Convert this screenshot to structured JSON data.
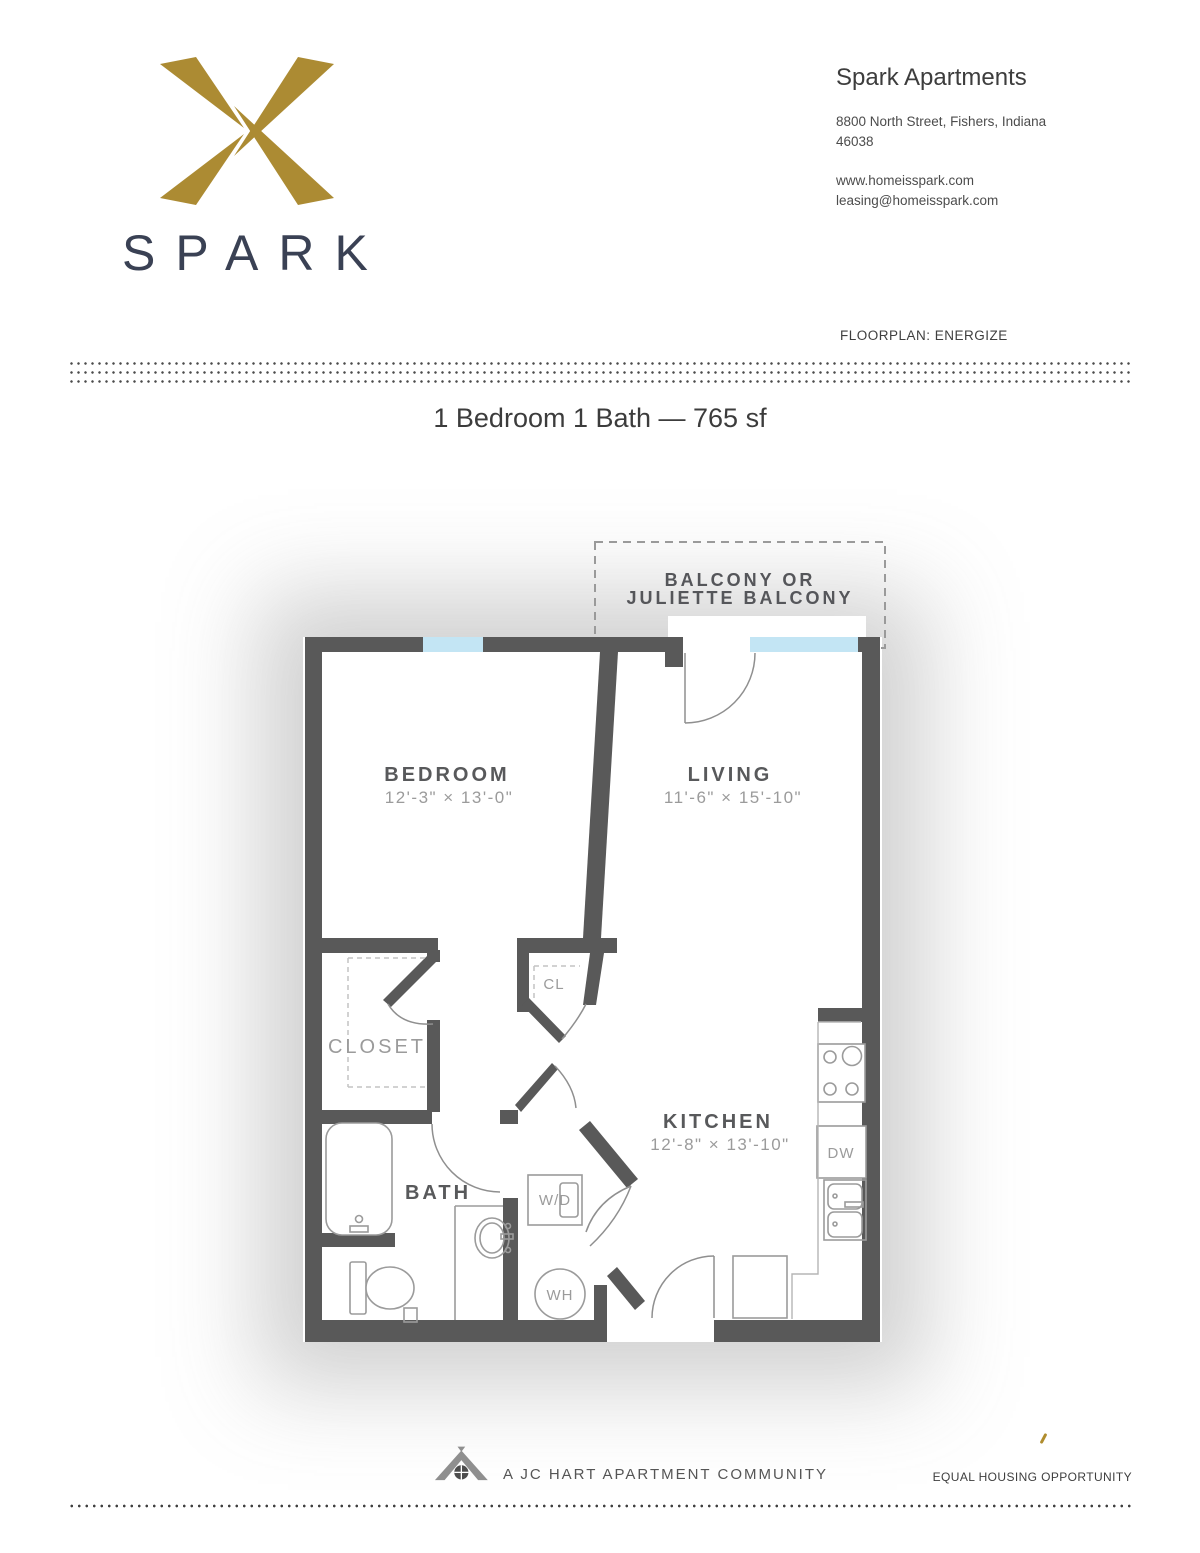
{
  "header": {
    "logo_wordmark": "SPARK",
    "brand_name": "Spark Apartments",
    "address_line1": "8800 North Street, Fishers, Indiana",
    "address_line2": "46038",
    "website": "www.homeisspark.com",
    "email": "leasing@homeisspark.com"
  },
  "floorplan_label": "FLOORPLAN: ENERGIZE",
  "title": "1 Bedroom 1 Bath — 765 sf",
  "plan": {
    "balcony": {
      "line1": "BALCONY OR",
      "line2": "JULIETTE BALCONY"
    },
    "rooms": {
      "bedroom": {
        "name": "BEDROOM",
        "dims": "12'-3\" × 13'-0\""
      },
      "living": {
        "name": "LIVING",
        "dims": "11'-6\" × 15'-10\""
      },
      "kitchen": {
        "name": "KITCHEN",
        "dims": "12'-8\" × 13'-10\""
      },
      "bath": {
        "name": "BATH"
      },
      "closet": {
        "name": "CLOSET"
      },
      "closet_small": {
        "name": "CL"
      }
    },
    "fixtures": {
      "washer_dryer": "W/D",
      "water_heater": "WH",
      "dishwasher": "DW"
    },
    "colors": {
      "wall": "#595959",
      "window": "#c3e5f4",
      "room_label": "#58595b",
      "dim_label": "#9b9b9b",
      "brand_gold": "#ac8b33",
      "brand_navy": "#3a4154"
    }
  },
  "footer": {
    "community": "A JC HART APARTMENT COMMUNITY",
    "equal_housing": "EQUAL HOUSING OPPORTUNITY"
  }
}
